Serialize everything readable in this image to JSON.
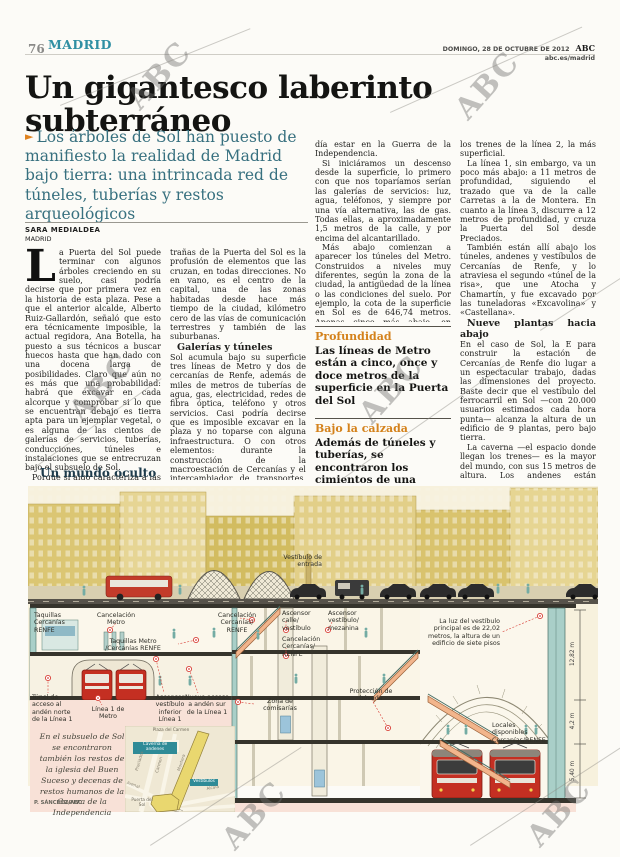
{
  "page": {
    "number": "76",
    "section": "MADRID",
    "date_line": "DOMINGO, 28 DE OCTUBRE DE 2012",
    "brand": "ABC",
    "site": "abc.es/madrid"
  },
  "watermark": {
    "text": "ABC"
  },
  "article": {
    "headline": "Un gigantesco laberinto subterráneo",
    "lead_bullet": "►",
    "lead": "Los árboles de Sol han puesto de manifiesto la realidad de Madrid bajo tierra: una intrincada red de túneles, tuberías y restos arqueológicos",
    "byline": "SARA MEDIALDEA",
    "byline_place": "MADRID",
    "dropcap": "L",
    "col1_p1": "a Puerta del Sol puede terminar con algunos árboles creciendo en su suelo, casi podría decirse que por primera vez en la historia de esta plaza. Pese a que el anterior alcalde, Alberto Ruiz-Gallardón, señaló que esto era técnicamente imposible, la actual regidora, Ana Botella, ha puesto a sus técnicos a buscar huecos hasta que han dado con una docena larga de posibilidades. Claro que aún no es más que una probabilidad: habrá que excavar en cada alcorque y comprobar si lo que se encuentran debajo es tierra apta para un ejemplar vegetal, o es alguna de las cientos de galerías de servicios, tuberías, conducciones, túneles e instalaciones que se entrecruzan bajo el subsuelo de Sol.",
    "col1_p2": "Porque si algo caracteriza a las en-",
    "col2_p1": "trañas de la Puerta del Sol es la profusión de elementos que las cruzan, en todas direcciones. No en vano, es el centro de la capital, una de las zonas habitadas desde hace más tiempo de la ciudad, kilómetro cero de las vías de comunicación terrestres y también de las suburbanas.",
    "col2_h": "Galerías y túneles",
    "col2_p2": "Sol acumula bajo su superficie tres líneas de Metro y dos de cercanías de Renfe, además de miles de metros de tuberías de agua, gas, electricidad, redes de fibra óptica, teléfono y otros servicios. Casi podría decirse que es imposible excavar en la plaza y no toparse con alguna infraestructura. O con otros elementos: durante la construcción de la macroestación de Cercanías y el intercambiador de transportes, se hallaron los restos de la iglesia del Buen Suceso. Y también se localizaron decenas de restos humanos, cuyo origen, según se estudió, po-",
    "col3_p1": "día estar en la Guerra de la Independencia.",
    "col3_p2": "Si iniciáramos un descenso desde la superficie, lo primero con que nos toparíamos serían las galerías de servicios: luz, agua, teléfonos, y siempre por una vía alternativa, las de gas. Todas ellas, a aproximadamente 1,5 metros de la calle, y por encima del alcantarillado.",
    "col3_p3": "Más abajo comienzan a aparecer los túneles del Metro. Construidos a niveles muy diferentes, según la zona de la ciudad, la antigüedad de la línea o las condiciones del suelo. Por ejemplo, la cota de la superficie en Sol es de 646,74 metros. Apenas cinco más abajo, en sentido Alcalá-Arenal, discurren",
    "callout1_title": "Profundidad",
    "callout1_text": "Las líneas de Metro están a cinco, once y doce metros de la superficie en la Puerta del Sol",
    "callout2_title": "Bajo la calzada",
    "callout2_text": "Además de túneles y tuberías, se encontraron los cimientos de una iglesia y hasta restos humanos",
    "col4_p1": "los trenes de la línea 2, la más superficial.",
    "col4_p2": "La línea 1, sin embargo, va un poco más abajo: a 11 metros de profundidad, siguiendo el trazado que va de la calle Carretas a la de Montera. En cuanto a la línea 3, discurre a 12 metros de profundidad, y cruza la Puerta del Sol desde Preciados.",
    "col4_p3": "También están allí abajo los túneles, andenes y vestíbulos de Cercanías de Renfe, y lo atraviesa el segundo «túnel de la risa», que une Atocha y Chamartín, y fue excavado por las tuneladoras «Excavolina» y «Castellana».",
    "col4_h": "Nueve plantas hacia abajo",
    "col4_p4": "En el caso de Sol, la E para construir la estación de Cercanías de Renfe dio lugar a un espectacular trabajo, dadas las dimensiones del proyecto. Baste decir que el vestíbulo del ferrocarril en Sol —con 20.000 usuarios estimados cada hora punta— alcanza la altura de un edificio de 9 plantas, pero bajo tierra.",
    "col4_p5": "La caverna —el espacio donde llegan los trenes— es la mayor del mundo, con sus 15 metros de altura. Los andenes están preparados para poder albergar un caso extremo: la llegada simultánea de dos trenes completos, uno de ellos doble, y que todos los viajeros se bajaran allí. Total: 2.400 usua-"
  },
  "infographic": {
    "title": "Un mundo oculto",
    "labels": {
      "vestibulo_entrada": "Vestíbulo de entrada",
      "taquillas_cercanias": "Taquillas Cercanías RENFE",
      "cancelacion_metro": "Cancelación Metro",
      "taquillas_metro": "Taquillas Metro /Cercanías RENFE",
      "cancelacion_cercanias_izq": "Cancelación Cercanías/ RENFE",
      "ascensor_calle": "Ascensor calle/ vestíbulo",
      "cancelacion_cercanias_der": "Cancelación Cercanías/ RENFE",
      "ascensor_mezanina": "Ascensor vestíbulo/ mezanina",
      "luz_vestibulo": "La luz del vestíbulo principal es de 22,02 metros, la altura de un edificio de siete pisos",
      "zona_comisarias": "Zona de comisarías",
      "proteccion_boveda": "Protección de bóveda",
      "tunel_acceso": "Túnel de acceso al andén norte de la Línea 1",
      "linea1": "Línea 1 de Metro",
      "ascensor_inferior": "Ascensor vestíbulo inferior Línea 1",
      "nuevo_acceso": "Nuevo acceso a andén sur de la Línea 1",
      "locales": "Locales disponibles Cercanías/RENFE"
    },
    "dims": [
      "12,82 m",
      "4,2 m",
      "5,40 m"
    ],
    "caption": "En el subsuelo de Sol se encontraron también los restos de la iglesia del Buen Suceso y decenas de restos humanos de la Guerra de la Independencia",
    "credit": "P. SÁNCHEZ/ABC",
    "map": {
      "plaza_carmen": "Plaza del Carmen",
      "caverna_box": "Caverna de andenes",
      "vestibulos_box": "Vestíbulos",
      "puerta_sol": "Puerta del Sol",
      "streets": {
        "preciados": "Preciados",
        "carmen": "Carmen",
        "montera": "Montera",
        "alcala": "Alcalá",
        "arenal": "Arenal"
      }
    }
  }
}
